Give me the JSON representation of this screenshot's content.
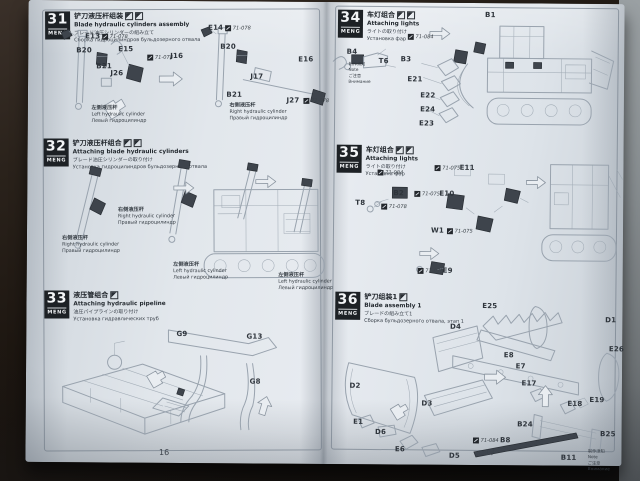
{
  "brand": "MENG",
  "colors": {
    "paper": "#dfe4ea",
    "ink": "#31373e",
    "line_art": "#98a2ad",
    "header_bg": "#1d2125",
    "painted_part": "#3e444c",
    "backdrop": "#17120e",
    "side_strip": "#82878b"
  },
  "left_page": {
    "page_number": "16",
    "steps": [
      {
        "number": "31",
        "titles": {
          "cn": "铲刀液压杆组装",
          "en": "Blade hydraulic cylinders assembly",
          "jp": "ブレード油圧シリンダーの組み立て",
          "ru": "Сборка гидроцилиндров бульдозерного отвала"
        },
        "parts": [
          {
            "label": "E13",
            "paint": "71-078"
          },
          {
            "label": "B20"
          },
          {
            "label": "B21"
          },
          {
            "label": "E15"
          },
          {
            "label": "J16",
            "paint": "71-078"
          },
          {
            "label": "J26"
          },
          {
            "label": "E14",
            "paint": "71-078"
          },
          {
            "label": "B20"
          },
          {
            "label": "E16"
          },
          {
            "label": "J17"
          },
          {
            "label": "B21"
          },
          {
            "label": "J27",
            "paint": "71-078"
          }
        ],
        "captions": [
          {
            "cn": "左侧液压杆",
            "en": "Left hydraulic cylinder",
            "ru": "Левый гидроцилиндр"
          },
          {
            "cn": "右侧液压杆",
            "en": "Right hydraulic cylinder",
            "ru": "Правый гидроцилиндр"
          }
        ]
      },
      {
        "number": "32",
        "titles": {
          "cn": "铲刀液压杆组合",
          "en": "Attaching blade hydraulic cylinders",
          "jp": "ブレード油圧シリンダーの取り付け",
          "ru": "Установка гидроцилиндров бульдозерного отвала"
        },
        "captions": [
          {
            "cn": "右侧液压杆",
            "en": "Right hydraulic cylinder",
            "ru": "Правый гидроцилиндр"
          },
          {
            "cn": "右侧液压杆",
            "en": "Right hydraulic cylinder",
            "ru": "Правый гидроцилиндр"
          },
          {
            "cn": "左侧液压杆",
            "en": "Left hydraulic cylinder",
            "ru": "Левый гидроцилиндр"
          },
          {
            "cn": "左侧液压杆",
            "en": "Left hydraulic cylinder",
            "ru": "Левый гидроцилиндр"
          }
        ]
      },
      {
        "number": "33",
        "titles": {
          "cn": "液压管组合",
          "en": "Attaching hydraulic pipeline",
          "jp": "油圧パイプラインの取り付け",
          "ru": "Установка гидравлических труб"
        },
        "parts": [
          {
            "label": "G9"
          },
          {
            "label": "G13"
          },
          {
            "label": "G8"
          }
        ]
      }
    ]
  },
  "right_page": {
    "page_number": "17",
    "steps": [
      {
        "number": "34",
        "titles": {
          "cn": "车灯组合",
          "en": "Attaching lights",
          "jp": "ライトの取り付け",
          "ru": "Установка фар"
        },
        "paint_note": "71-084",
        "parts": [
          {
            "label": "B4"
          },
          {
            "label": "T6"
          },
          {
            "label": "B3"
          },
          {
            "label": "E21"
          },
          {
            "label": "E22"
          },
          {
            "label": "E24"
          },
          {
            "label": "E23"
          },
          {
            "label": "B1"
          }
        ],
        "note": {
          "l1": "制作须知",
          "l2": "Note",
          "l3": "ご注意",
          "l4": "Внимание"
        }
      },
      {
        "number": "35",
        "titles": {
          "cn": "车灯组合",
          "en": "Attaching lights",
          "jp": "ライトの取り付け",
          "ru": "Установка фар"
        },
        "parts": [
          {
            "label": "B2",
            "paint": "71-084"
          },
          {
            "label": "T8",
            "paint": "71-078"
          },
          {
            "label": "E11",
            "paint": "71-075"
          },
          {
            "label": "E10",
            "paint": "71-075"
          },
          {
            "label": "W1",
            "paint": "71-075"
          },
          {
            "label": "E9",
            "paint": "71-075"
          }
        ]
      },
      {
        "number": "36",
        "titles": {
          "cn": "铲刀组装1",
          "en": "Blade assembly 1",
          "jp": "ブレードの組み立て1",
          "ru": "Сборка бульдозерного отвала, этап 1"
        },
        "parts": [
          {
            "label": "E25"
          },
          {
            "label": "D4"
          },
          {
            "label": "D2"
          },
          {
            "label": "D3"
          },
          {
            "label": "E1"
          },
          {
            "label": "D6"
          },
          {
            "label": "E6"
          },
          {
            "label": "D5"
          },
          {
            "label": "D1"
          },
          {
            "label": "E8"
          },
          {
            "label": "E7"
          },
          {
            "label": "E26"
          },
          {
            "label": "E17"
          },
          {
            "label": "E18"
          },
          {
            "label": "E19"
          },
          {
            "label": "B24"
          },
          {
            "label": "B25"
          },
          {
            "label": "B8",
            "paint": "71-084"
          },
          {
            "label": "B11"
          }
        ],
        "note": {
          "l1": "制作须知",
          "l2": "Note",
          "l3": "ご注意",
          "l4": "Внимание"
        }
      }
    ]
  }
}
